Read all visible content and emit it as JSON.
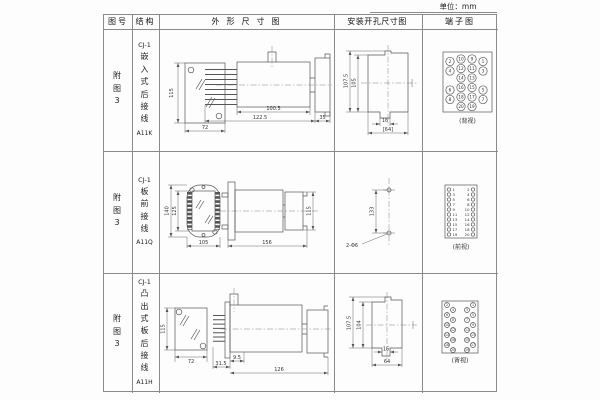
{
  "unit_label": "单位：mm",
  "colors": {
    "line": "#555555",
    "grid": "#8a8a8a",
    "text": "#222222"
  },
  "table": {
    "headers": {
      "fig": "图号",
      "structure": "结构",
      "outline": "外形尺寸图",
      "install": "安装开孔尺寸图",
      "terminal": "端子图"
    }
  },
  "rows": [
    {
      "fig": "附图3",
      "model": "CJ-1",
      "mount": "嵌入式后接线",
      "code": "A11K",
      "outline": {
        "front_h": "115",
        "front_w": "72",
        "d1": "100.5",
        "d2": "122.5",
        "d3": "35"
      },
      "install": {
        "outer": "107.5",
        "inner": "105",
        "slot": "16",
        "total": "[64]"
      },
      "terminal": {
        "label": "(背视)"
      }
    },
    {
      "fig": "附图3",
      "model": "CJ-1",
      "mount": "板前接线",
      "code": "A11Q",
      "outline": {
        "front_outer": "140",
        "front_inner": "125",
        "front_w": "105",
        "side_len": "156",
        "side_h": "115"
      },
      "install": {
        "pitch": "133",
        "hole": "2-Φ6"
      },
      "terminal": {
        "label": "(前视)"
      }
    },
    {
      "fig": "附图3",
      "model": "CJ-1",
      "mount": "凸出式板后接线",
      "code": "A11H",
      "outline": {
        "front_h": "115",
        "front_w": "72",
        "d1": "31.5",
        "d2": "9.5",
        "d3": "126"
      },
      "install": {
        "outer": "107.5",
        "inner": "104",
        "slot": "16",
        "total": "64"
      },
      "terminal": {
        "label": "(背视)"
      }
    }
  ],
  "terminals": {
    "back_grid": {
      "cols": [
        {
          "nums": [
            "2",
            "4",
            "6",
            "8"
          ],
          "slots": [
            0,
            1,
            3,
            4
          ],
          "offset": 2.5
        },
        {
          "nums": [
            "10",
            "12",
            "14",
            "16",
            "18",
            "20"
          ],
          "slots": [
            0,
            1,
            2,
            3,
            4,
            5
          ],
          "offset": 0
        },
        {
          "nums": [
            "9",
            "11",
            "13",
            "15",
            "17",
            "19"
          ],
          "slots": [
            0,
            1,
            2,
            3,
            4,
            5
          ],
          "offset": 0
        },
        {
          "nums": [
            "1",
            "3",
            "5",
            "7"
          ],
          "slots": [
            0,
            1,
            3,
            4
          ],
          "offset": 2.5
        }
      ]
    },
    "front_list": {
      "left": [
        "1",
        "3",
        "5",
        "7",
        "9",
        "11",
        "13",
        "15",
        "17",
        "19"
      ],
      "right": [
        "2",
        "4",
        "6",
        "8",
        "10",
        "12",
        "14",
        "16",
        "18",
        "20"
      ]
    },
    "back_stagger": {
      "left": [
        "2",
        "4",
        "6",
        "8",
        "10",
        "12",
        "14",
        "16",
        "18",
        "20"
      ],
      "right": [
        "1",
        "3",
        "5",
        "7",
        "9",
        "11",
        "13",
        "15",
        "17",
        "19"
      ]
    }
  }
}
